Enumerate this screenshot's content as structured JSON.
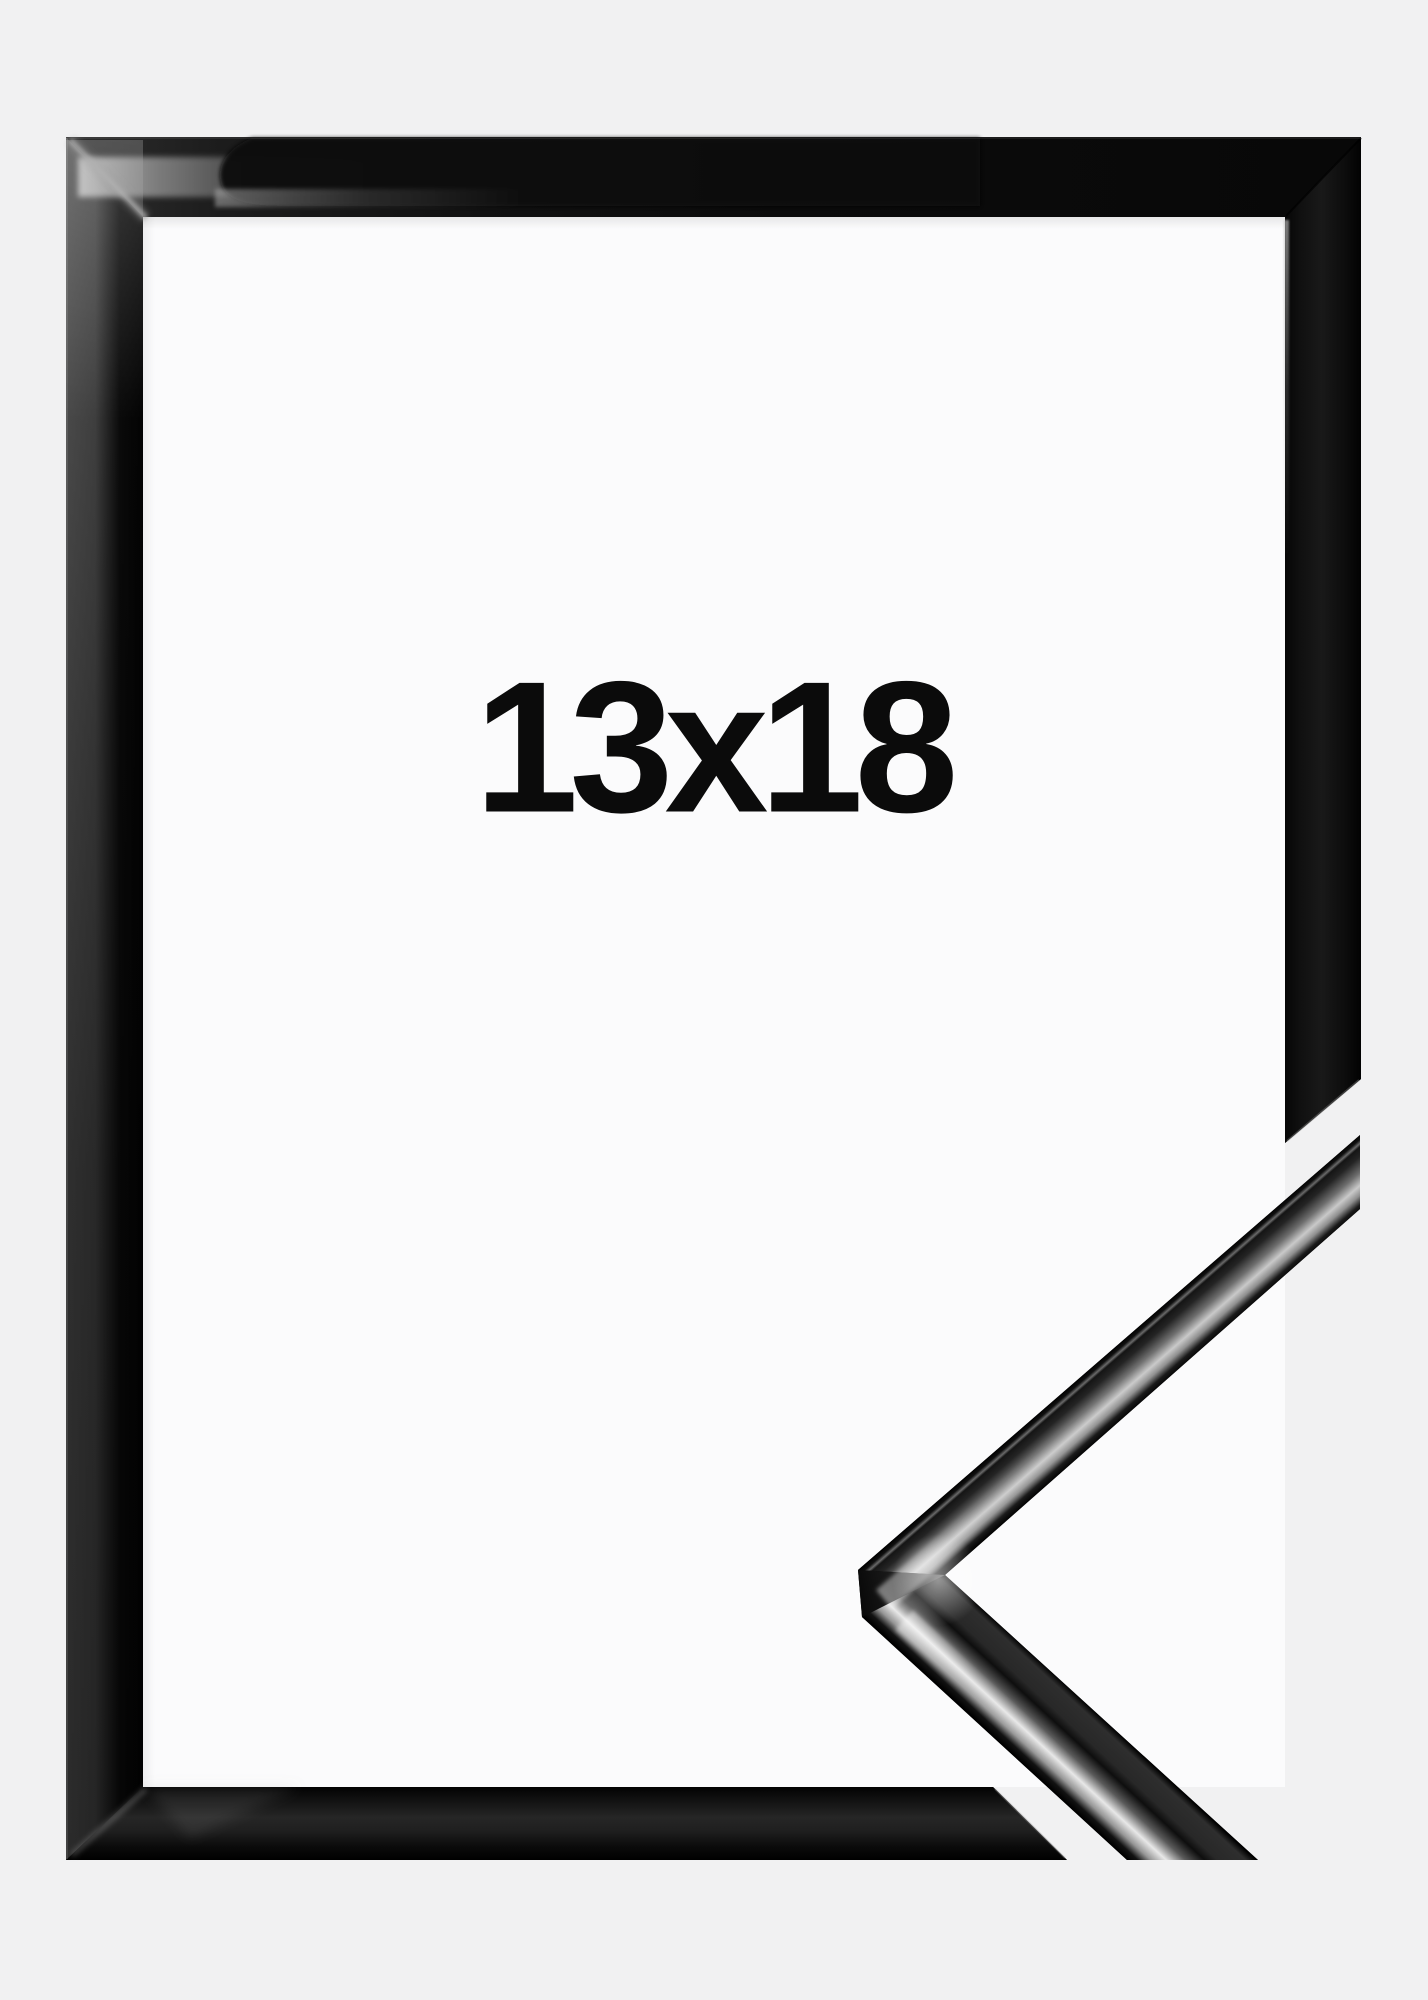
{
  "product": {
    "size_label": "13x18"
  },
  "colors": {
    "background": "#f1f1f2",
    "opening_white": "#fbfbfc",
    "frame_black": "#070707",
    "label_text": "#0b0b0b"
  }
}
